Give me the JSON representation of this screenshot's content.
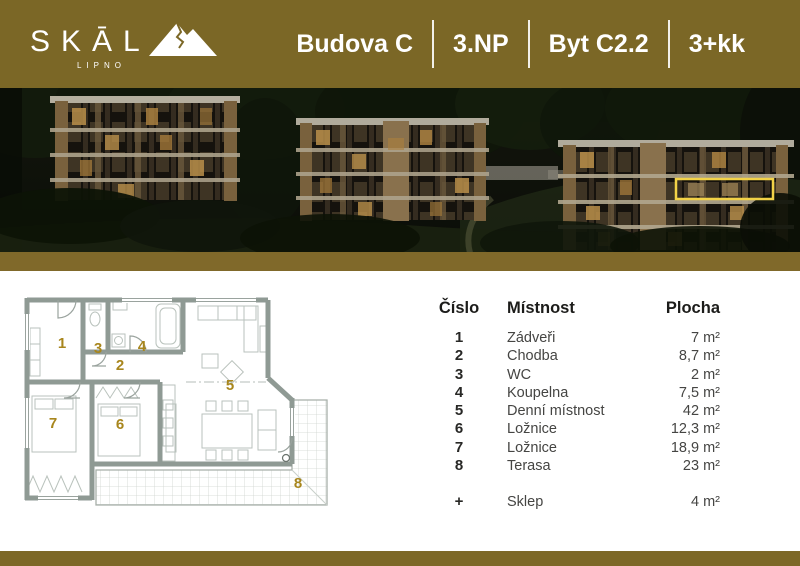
{
  "header": {
    "logo": {
      "brand": "SKĀL",
      "sub": "LIPNO",
      "icon": "mountain-icon"
    },
    "building": "Budova C",
    "floor": "3.NP",
    "unit": "Byt C2.2",
    "layout": "3+kk"
  },
  "hero": {
    "icon": "building-rendering",
    "highlight_color": "#f2d247"
  },
  "table": {
    "col_num": "Číslo",
    "col_room": "Místnost",
    "col_area": "Plocha",
    "rows": [
      {
        "num": "1",
        "room": "Zádveři",
        "area": "7 m²"
      },
      {
        "num": "2",
        "room": "Chodba",
        "area": "8,7 m²"
      },
      {
        "num": "3",
        "room": "WC",
        "area": "2 m²"
      },
      {
        "num": "4",
        "room": "Koupelna",
        "area": "7,5 m²"
      },
      {
        "num": "5",
        "room": "Denní místnost",
        "area": "42 m²"
      },
      {
        "num": "6",
        "room": "Ložnice",
        "area": "12,3 m²"
      },
      {
        "num": "7",
        "room": "Ložnice",
        "area": "18,9 m²"
      },
      {
        "num": "8",
        "room": "Terasa",
        "area": "23 m²"
      }
    ],
    "extra": {
      "num": "+",
      "room": "Sklep",
      "area": "4 m²"
    }
  },
  "colors": {
    "brand_gold": "#7b6726",
    "divider_gold": "#80692a",
    "room_number_gold": "#a8861d",
    "highlight_yellow": "#f2d247"
  }
}
